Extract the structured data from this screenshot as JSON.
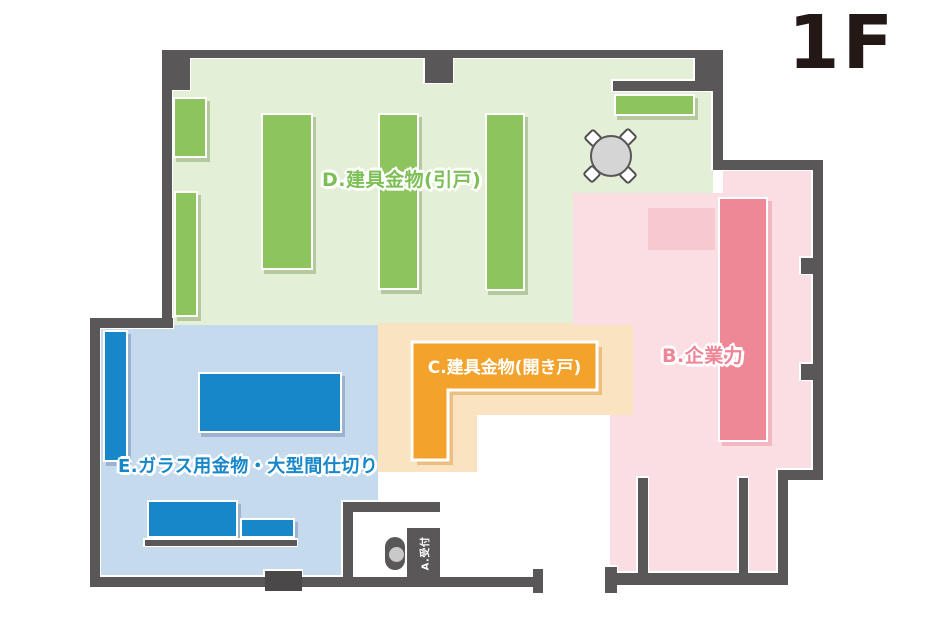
{
  "floor": {
    "label": "1F"
  },
  "zones": {
    "d": {
      "label": "D.建具金物(引戸)",
      "bg": "#e3efd7",
      "accent": "#8dc45e",
      "text": "#7cbf55"
    },
    "c": {
      "label": "C.建具金物(開き戸)",
      "bg": "#fae3c1",
      "accent": "#f3a32c",
      "text": "#ffffff"
    },
    "b": {
      "label": "B.企業力",
      "bg": "#fbdee3",
      "accent": "#ef8896",
      "soft": "#f6c9d1",
      "text": "#ee8495"
    },
    "e": {
      "label": "E.ガラス用金物・大型間仕切り",
      "bg": "#c6daee",
      "accent": "#1787c9",
      "text": "#1787c9"
    },
    "a": {
      "label": "A.受付"
    }
  },
  "furniture": {
    "round_table_seats": 4
  },
  "colors": {
    "page_bg": "#ffffff",
    "wall": "#595757",
    "door_stub": "#4a4848",
    "floor_title": "#231815",
    "table_fill": "#d5d5d6",
    "head_fill": "#c9c9ca"
  }
}
